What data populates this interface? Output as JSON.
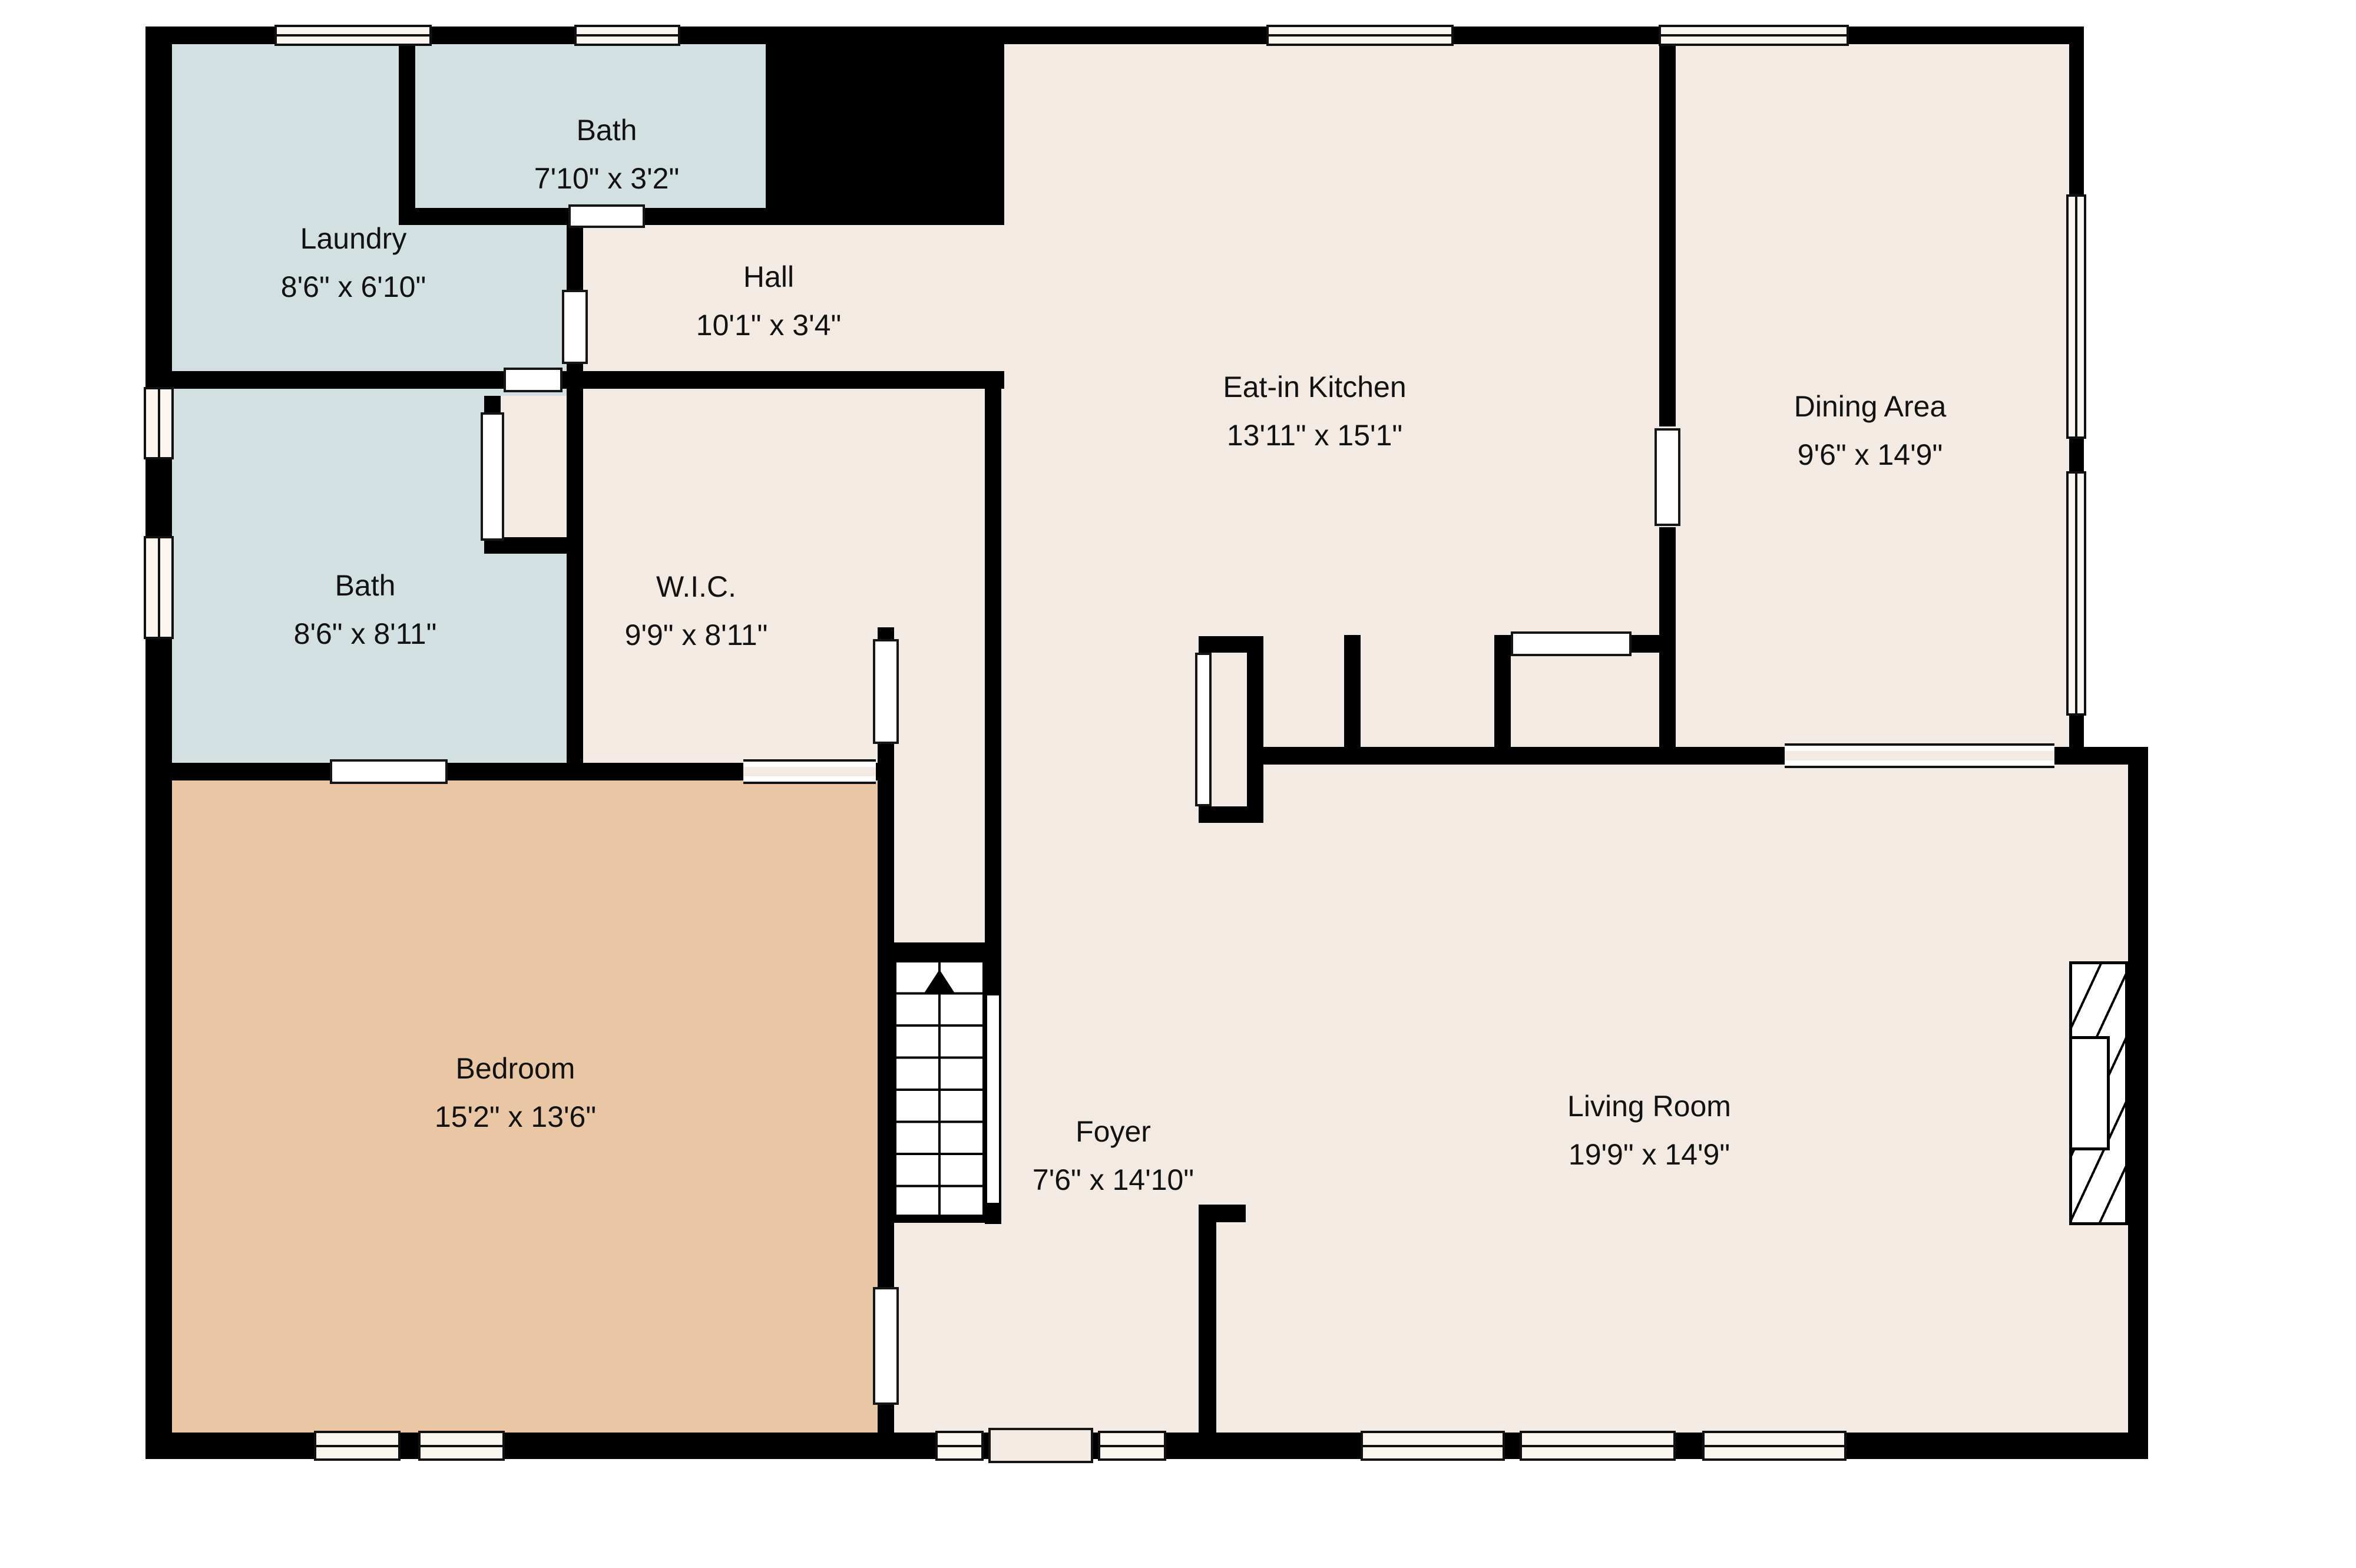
{
  "title": "Floor plan",
  "colors": {
    "floor": "#f2eae3",
    "wet_room": "#d2e0e1",
    "bedroom": "#e9c7a4",
    "wall": "#000000",
    "window_fill": "#faf5ef",
    "outline": "#161616"
  },
  "rooms": [
    {
      "id": "laundry",
      "name": "Laundry",
      "dims": "8'6\" x 6'10\""
    },
    {
      "id": "bath-upper",
      "name": "Bath",
      "dims": "7'10\" x 3'2\""
    },
    {
      "id": "hall",
      "name": "Hall",
      "dims": "10'1\" x 3'4\""
    },
    {
      "id": "kitchen",
      "name": "Eat-in Kitchen",
      "dims": "13'11\" x 15'1\""
    },
    {
      "id": "dining",
      "name": "Dining Area",
      "dims": "9'6\" x 14'9\""
    },
    {
      "id": "bath-lower",
      "name": "Bath",
      "dims": "8'6\" x 8'11\""
    },
    {
      "id": "wic",
      "name": "W.I.C.",
      "dims": "9'9\" x 8'11\""
    },
    {
      "id": "bedroom",
      "name": "Bedroom",
      "dims": "15'2\" x 13'6\""
    },
    {
      "id": "foyer",
      "name": "Foyer",
      "dims": "7'6\" x 14'10\""
    },
    {
      "id": "living",
      "name": "Living Room",
      "dims": "19'9\" x 14'9\""
    }
  ],
  "stairs": {
    "direction_arrow": "up"
  }
}
